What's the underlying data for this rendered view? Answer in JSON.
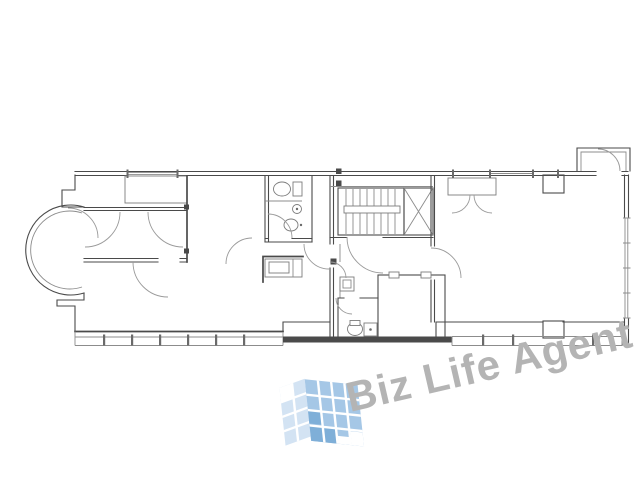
{
  "page": {
    "background_color": "#ffffff"
  },
  "floor_plan": {
    "type": "apartment-floor-plan-drawing",
    "wall_color": "#4a4a4a",
    "thin_line_color": "#8c8c8c",
    "features": [
      "round-bay-room",
      "walk-in-closet",
      "wardrobe",
      "bathroom",
      "toilet",
      "wash-basin",
      "kitchen-counter",
      "staircase",
      "elevator",
      "washroom",
      "wc",
      "storage-room",
      "living-room",
      "main-room",
      "entry-doors",
      "balcony-top-right",
      "balcony-bottom-left",
      "balcony-bottom-right",
      "windows",
      "pillars"
    ]
  },
  "watermark": {
    "text": "Biz Life Agent",
    "text_color": "#b4b4b4",
    "logo": {
      "left_face_color": "#d3e3f3",
      "right_face_color": "#a5c7e6",
      "accent_color": "#7fafd8"
    }
  }
}
